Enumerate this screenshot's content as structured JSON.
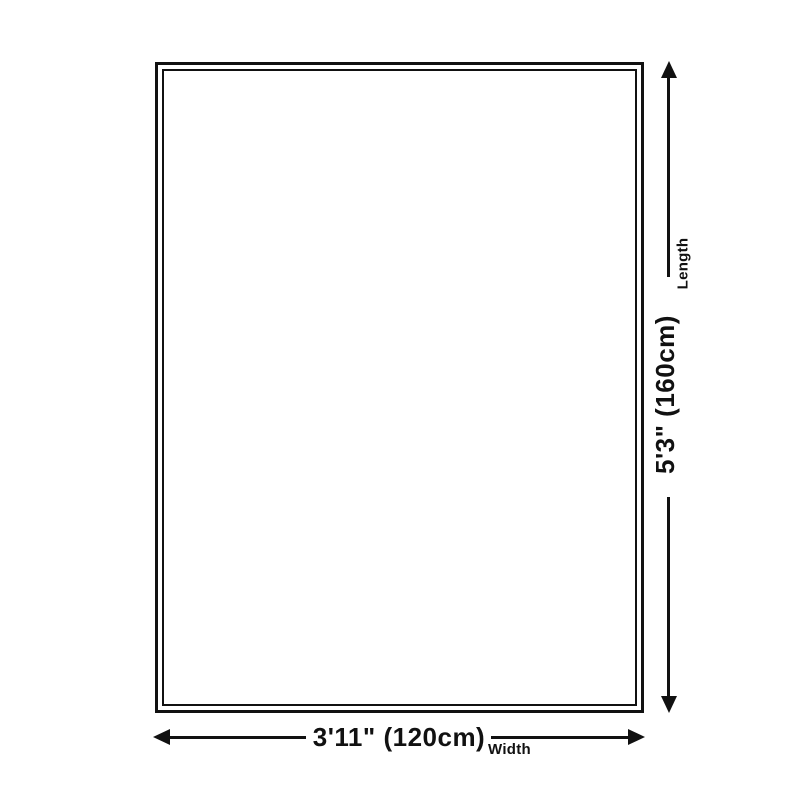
{
  "diagram": {
    "background_color": "#ffffff",
    "line_color": "#111111",
    "length": {
      "value": "5'3\" (160cm)",
      "label": "Length"
    },
    "width": {
      "value": "3'11\" (120cm)",
      "label": "Width"
    }
  }
}
